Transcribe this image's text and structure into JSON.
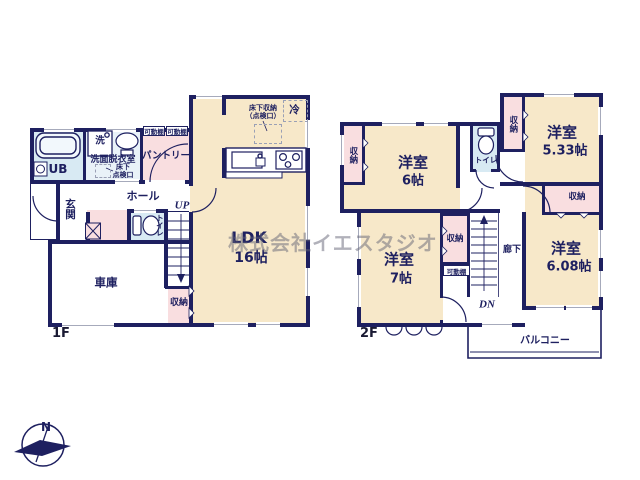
{
  "watermark": "株式会社イエスタジオ",
  "compass": {
    "north": "N"
  },
  "floor1": {
    "floor_label": "1F",
    "ldk": {
      "name": "LDK",
      "size": "16帖"
    },
    "underfloor_storage": {
      "line1": "床下収納",
      "line2": "（点検口）"
    },
    "fridge": "冷",
    "ub": "UB",
    "washer": "洗",
    "washroom": "洗面脱衣室",
    "floor_hatch": {
      "line1": "床下",
      "line2": "点検口"
    },
    "shelf1": "可動棚",
    "shelf2": "可動棚",
    "pantry": "パントリー",
    "entrance": "玄関",
    "hall": "ホール",
    "toilet": "トイレ",
    "up": "UP",
    "garage": "車庫",
    "storage": "収納"
  },
  "floor2": {
    "floor_label": "2F",
    "closet_nw": "収納",
    "room6": {
      "name": "洋室",
      "size": "6帖"
    },
    "toilet": "トイレ",
    "closet_ne": "収納",
    "room533": {
      "name": "洋室",
      "size": "5.33帖"
    },
    "closet_e": "収納",
    "room608": {
      "name": "洋室",
      "size": "6.08帖"
    },
    "room7": {
      "name": "洋室",
      "size": "7帖"
    },
    "closet_c": "収納",
    "shelf": "可動棚",
    "corridor": "廊下",
    "dn": "DN",
    "balcony": "バルコニー"
  }
}
